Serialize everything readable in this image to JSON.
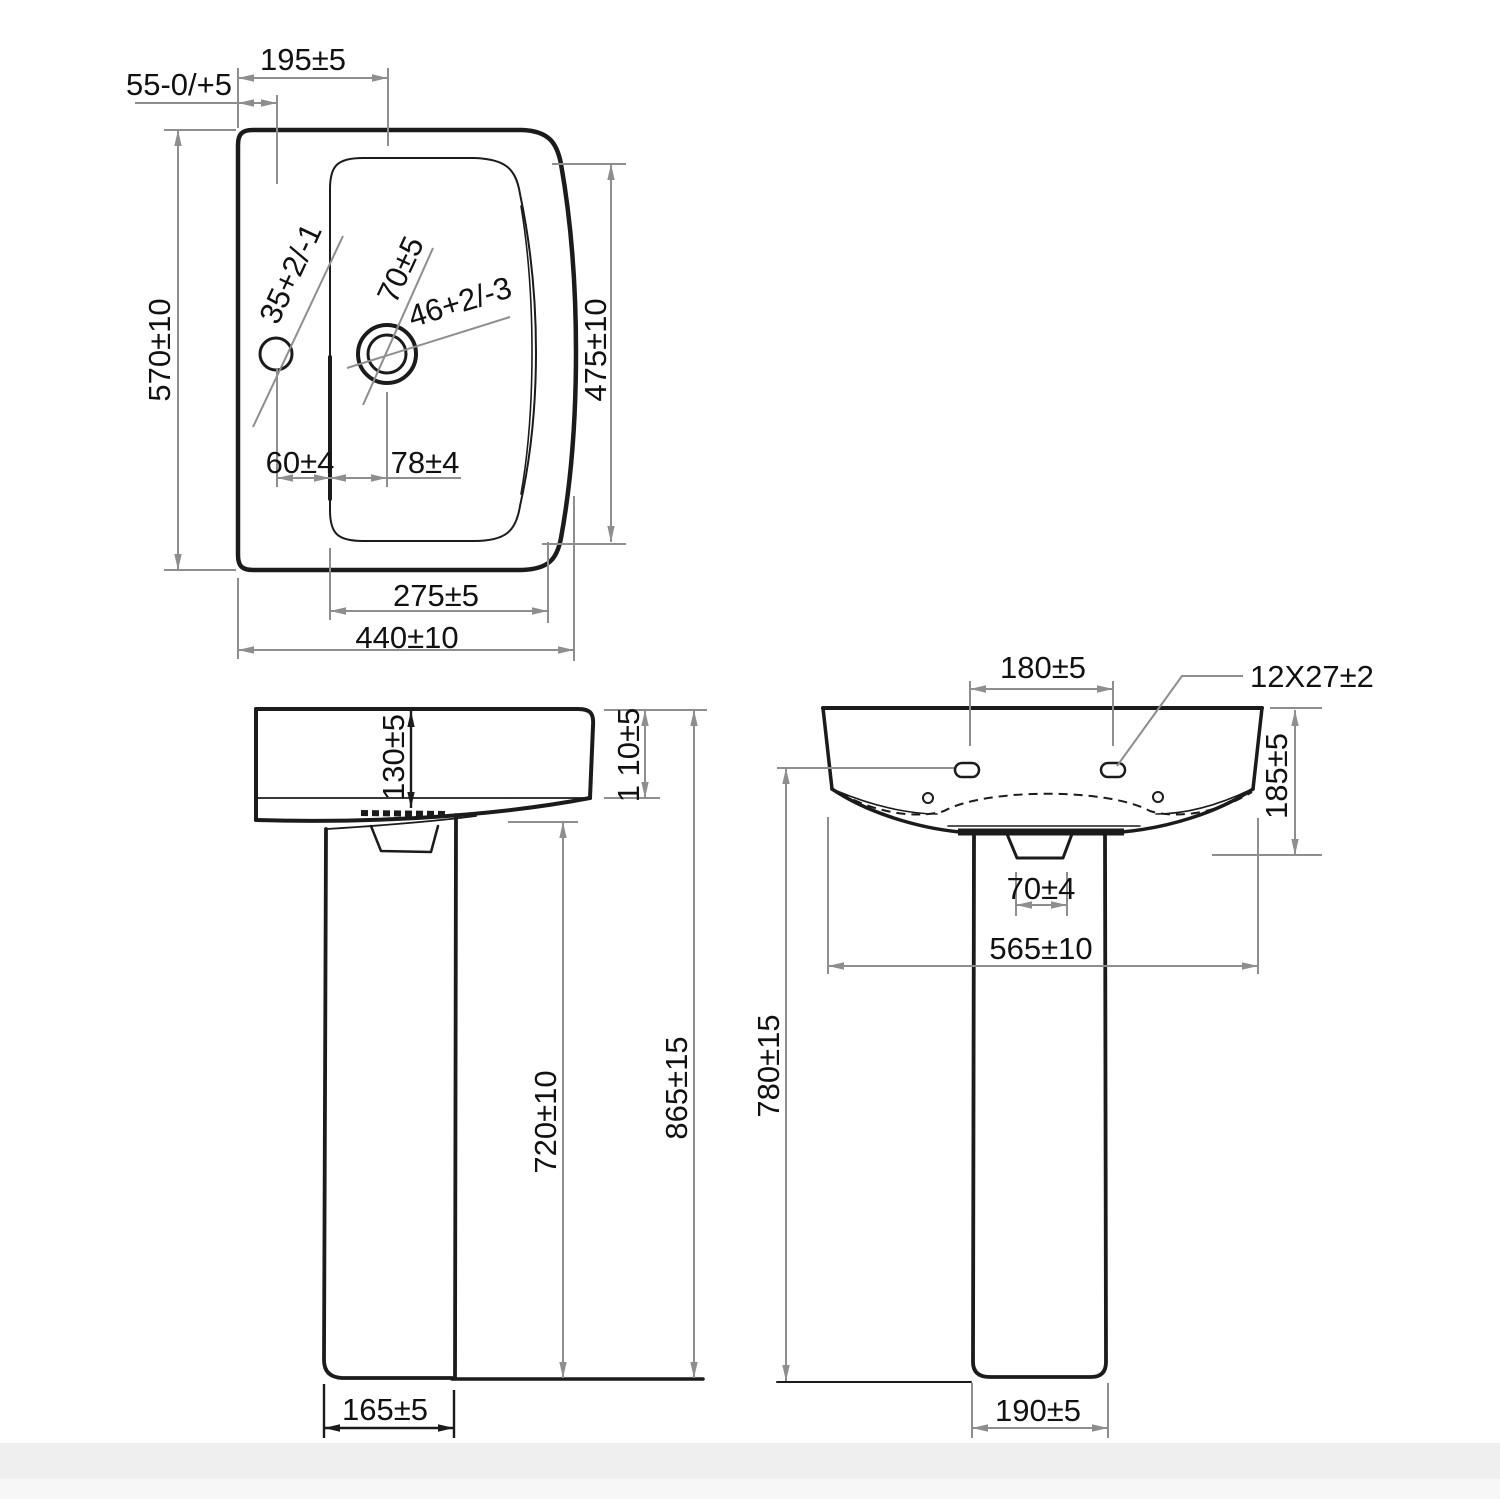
{
  "drawing": {
    "subject": "Pedestal wash basin dimensioned technical drawing (3 views)",
    "colors": {
      "outline": "#1b1b1b",
      "dimension_line": "#8e8e8e",
      "text": "#111111",
      "background": "#ffffff",
      "footer_band": "#efefef"
    },
    "views": {
      "plan": {
        "name": "Basin plan (top) view",
        "labels": {
          "tap_ledge_width": "195±5",
          "tap_ledge_offset": "55-0/+5",
          "depth_total": "570±10",
          "depth_inner": "475±10",
          "tap_hole_dia": "35+2/-1",
          "drain_inner_dia": "70±5",
          "drain_outer_dia": "46+2/-3",
          "hole_offset_left": "60±4",
          "hole_offset_right": "78±4",
          "inner_width": "275±5",
          "width_total": "440±10"
        }
      },
      "side": {
        "name": "Side elevation",
        "labels": {
          "rim_depth": "130±5",
          "apron_height": "1 10±5",
          "pedestal_height": "720±10",
          "total_height": "865±15",
          "base_depth": "165±5"
        }
      },
      "front": {
        "name": "Front elevation",
        "labels": {
          "fixing_hole_spacing": "180±5",
          "fixing_hole_size": "12X27±2",
          "basin_body_height": "185±5",
          "drain_boss_width": "70±4",
          "basin_width": "565±10",
          "fixing_height": "780±15",
          "base_width": "190±5"
        }
      }
    }
  }
}
